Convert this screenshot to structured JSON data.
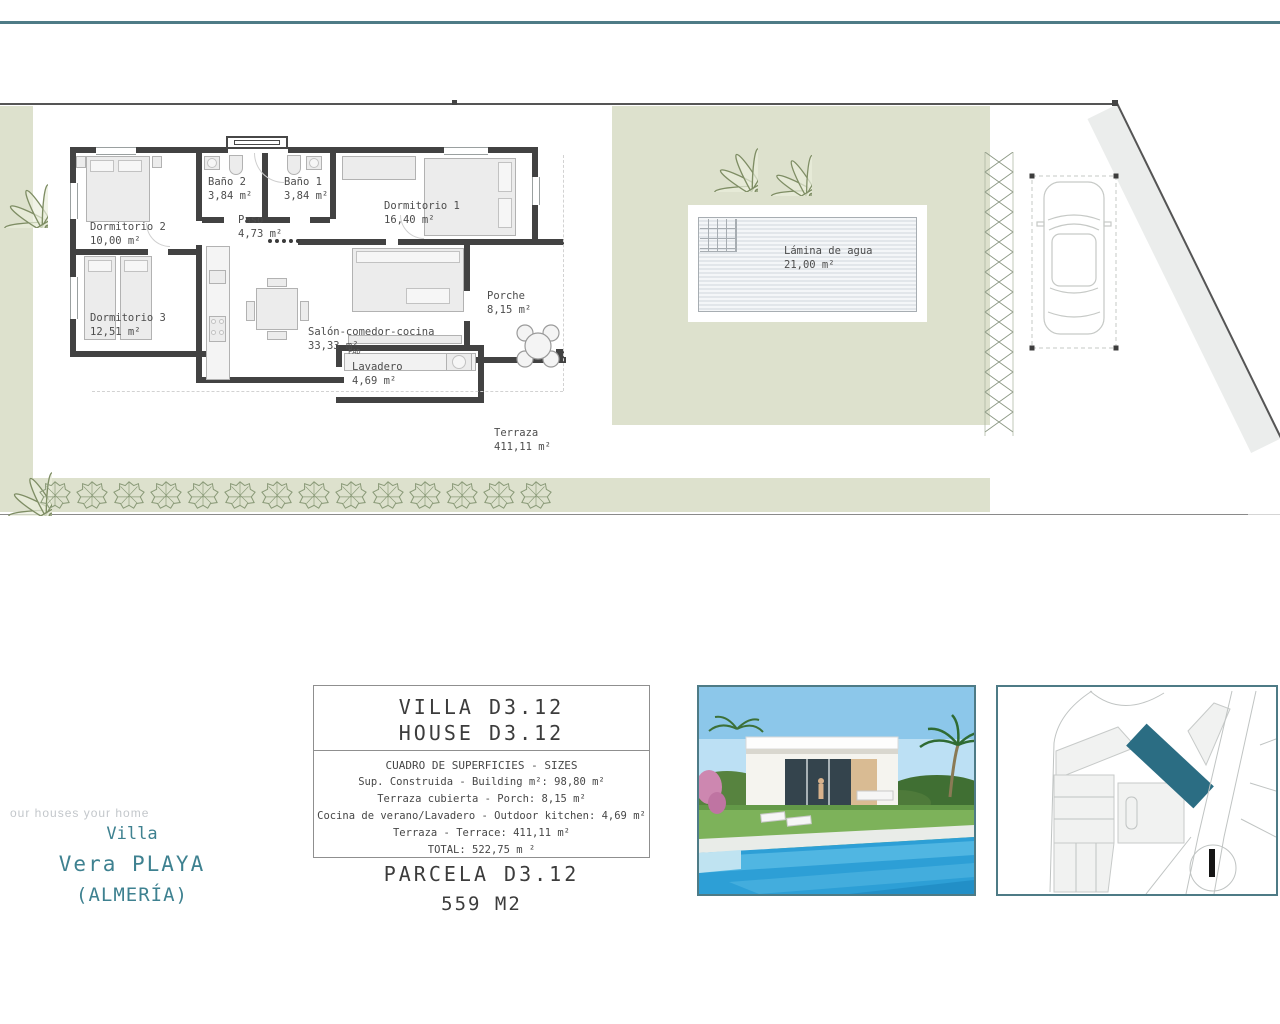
{
  "colors": {
    "accent_teal": "#4e7b86",
    "teal_text": "#3e8190",
    "sage_green": "#dde1cd",
    "wall_gray": "#424242",
    "parcel_highlight": "#2b6d83"
  },
  "plan": {
    "rooms": [
      {
        "name": "Baño 2",
        "area": "3,84 m²"
      },
      {
        "name": "Baño 1",
        "area": "3,84 m²"
      },
      {
        "name": "Dormitorio 1",
        "area": "16,40 m²"
      },
      {
        "name": "Dormitorio 2",
        "area": "10,00 m²"
      },
      {
        "name": "Paso",
        "area": "4,73 m²"
      },
      {
        "name": "Dormitorio 3",
        "area": "12,51 m²"
      },
      {
        "name": "Salón-comedor-cocina",
        "area": "33,33 m²"
      },
      {
        "name": "Porche",
        "area": "8,15 m²"
      },
      {
        "name": "Lavadero",
        "area": "4,69 m²"
      },
      {
        "name": "Terraza",
        "area": "411,11 m²"
      },
      {
        "name": "Lámina de agua",
        "area": "21,00 m²"
      }
    ],
    "fad_label": "FAD"
  },
  "info_box": {
    "title_line1": "VILLA D3.12",
    "title_line2": "HOUSE D3.12",
    "table_title": "CUADRO DE SUPERFICIES  - SIZES",
    "rows": [
      "Sup. Construida  - Building m²: 98,80 m²",
      "Terraza cubierta  - Porch: 8,15 m²",
      "Cocina de verano/Lavadero  - Outdoor kitchen: 4,69 m²",
      "Terraza - Terrace: 411,11 m²",
      "TOTAL:  522,75 m ²"
    ],
    "parcel_title": "PARCELA D3.12",
    "parcel_area": "559 M2"
  },
  "branding": {
    "slogan": "our houses your home",
    "line1": "Villa",
    "line2": "Vera PLAYA",
    "line3": "(ALMERÍA)"
  }
}
